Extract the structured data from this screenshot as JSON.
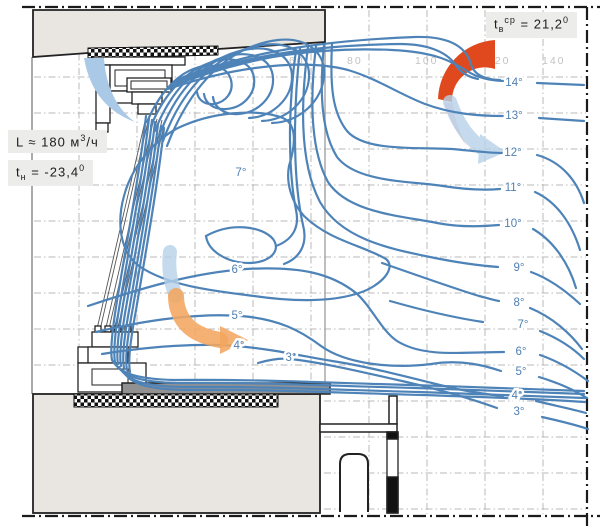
{
  "boxes": {
    "flow": {
      "main": "L ≈ 180 м",
      "sup": "3",
      "tail": "/ч"
    },
    "outdoor": {
      "t": "t",
      "sub": "н",
      "mid": " = -23,4",
      "sup": "0"
    },
    "indoor": {
      "t": "t",
      "sub": "в",
      "sup1": "ср",
      "mid": " = 21,2",
      "sup2": "0"
    }
  },
  "isotherms": {
    "right": [
      "14°",
      "13°",
      "12°",
      "11°",
      "10°",
      "9°",
      "8°",
      "7°",
      "6°",
      "5°",
      "4°",
      "3°"
    ],
    "mid": [
      "7°",
      "6°",
      "5°",
      "4°",
      "3°"
    ]
  },
  "scale": [
    "60",
    "80",
    "100",
    "120",
    "140"
  ],
  "colors": {
    "isotherm_blue": "#4e83b8",
    "warm_arrow_strong": "#e0491d",
    "warm_arrow_soft": "#f2a660",
    "cold_arrow": "#a9c9e6",
    "wall_gray": "#e9e6e1",
    "sill_gray": "#919191"
  }
}
